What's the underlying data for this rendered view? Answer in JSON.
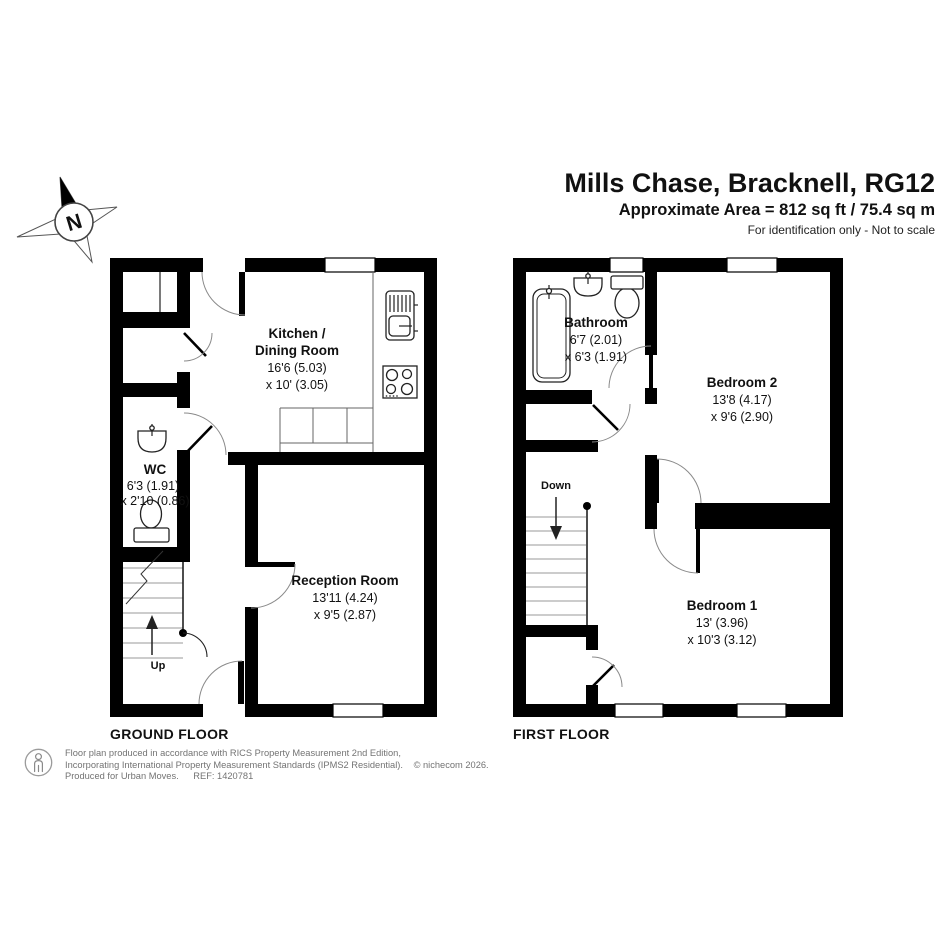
{
  "header": {
    "title": "Mills Chase, Bracknell, RG12",
    "area": "Approximate Area = 812 sq ft / 75.4 sq m",
    "note": "For identification only - Not to scale"
  },
  "compass": {
    "label": "N"
  },
  "ground_floor": {
    "label": "GROUND FLOOR",
    "stairs_label": "Up",
    "kitchen_name1": "Kitchen /",
    "kitchen_name2": "Dining Room",
    "kitchen_dim1": "16'6 (5.03)",
    "kitchen_dim2": "x 10' (3.05)",
    "wc_name": "WC",
    "wc_dim1": "6'3 (1.91)",
    "wc_dim2": "x 2'10 (0.86)",
    "reception_name": "Reception Room",
    "reception_dim1": "13'11 (4.24)",
    "reception_dim2": "x 9'5 (2.87)"
  },
  "first_floor": {
    "label": "FIRST FLOOR",
    "stairs_label": "Down",
    "bathroom_name": "Bathroom",
    "bathroom_dim1": "6'7 (2.01)",
    "bathroom_dim2": "x 6'3 (1.91)",
    "bedroom2_name": "Bedroom 2",
    "bedroom2_dim1": "13'8 (4.17)",
    "bedroom2_dim2": "x 9'6 (2.90)",
    "bedroom1_name": "Bedroom 1",
    "bedroom1_dim1": "13' (3.96)",
    "bedroom1_dim2": "x 10'3 (3.12)"
  },
  "footer": {
    "line1": "Floor plan produced in accordance with RICS Property Measurement 2nd Edition,",
    "line2": "Incorporating International Property Measurement Standards (IPMS2 Residential).",
    "copyright": "© nichecom 2026.",
    "line3a": "Produced for Urban Moves.",
    "line3b": "REF: 1420781"
  },
  "colors": {
    "wall": "#000000",
    "door_arc": "#8a8a8a",
    "stair_tread": "#9a9a9a",
    "footer_text": "#737373"
  }
}
